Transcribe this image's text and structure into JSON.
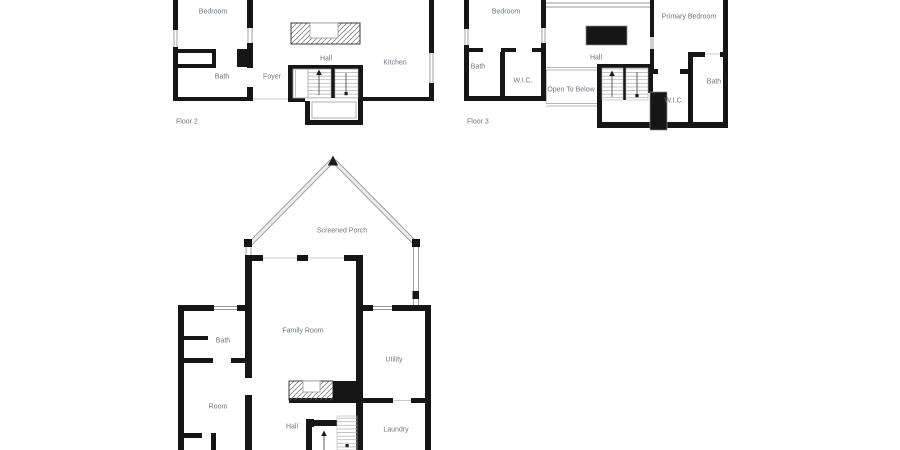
{
  "colors": {
    "wall": "#161616",
    "thin": "#979797",
    "text": "#70747a",
    "background": "#ffffff"
  },
  "floors": {
    "floor2": {
      "label": "Floor 2",
      "rooms": {
        "bedroom": "Bedroom",
        "bath": "Bath",
        "foyer": "Foyer",
        "hall": "Hall",
        "kitchen": "Kitchen"
      }
    },
    "floor3": {
      "label": "Floor 3",
      "rooms": {
        "bedroom": "Bedroom",
        "bath_left": "Bath",
        "wic_left": "W.I.C.",
        "hall": "Hall",
        "open_to_below": "Open To Below",
        "primary_bedroom": "Primary Bedroom",
        "wic_right": "W.I.C.",
        "bath_right": "Bath"
      }
    },
    "floor1": {
      "rooms": {
        "screened_porch": "Screened Porch",
        "family_room": "Family Room",
        "bath": "Bath",
        "room": "Room",
        "utility": "Utility",
        "hall": "Hall",
        "laundry": "Laundry"
      }
    }
  }
}
